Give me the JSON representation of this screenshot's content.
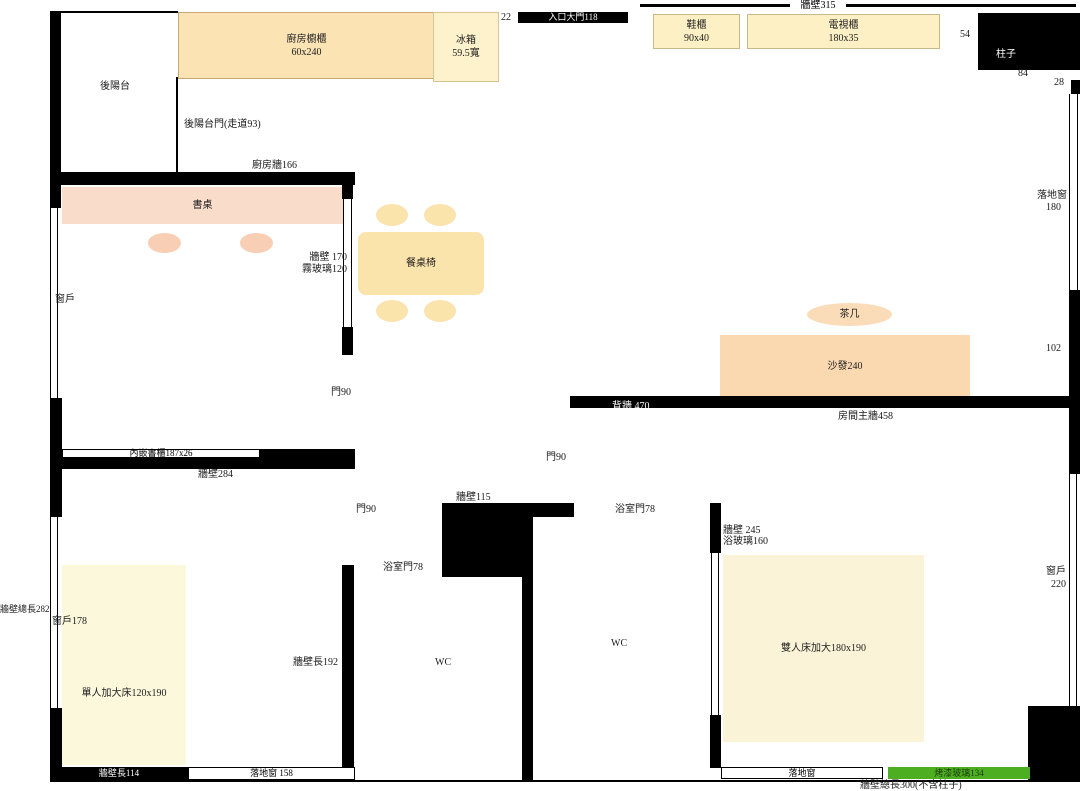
{
  "document": {
    "type": "floor-plan-diagram",
    "units": "cm"
  },
  "colors": {
    "wall": "#000000",
    "kitchen_cabinet_fill": "#FBE3B4",
    "fridge_fill": "#FDF2CB",
    "cabinet_yellow_fill": "#FCF0C4",
    "desk_pink_fill": "#FADCCB",
    "chair_pink_fill": "#F8CFB4",
    "dining_wheat_fill": "#FBE3AC",
    "sofa_peach_fill": "#FBD9B0",
    "coffee_table_fill": "#FBDCB9",
    "single_bed_fill": "#FCF8DC",
    "double_bed_fill": "#FAF3D7",
    "painted_glass_green": "#4CAE20"
  },
  "labels": {
    "balcony": "後陽台",
    "balcony_door": "後陽台門(走道93)",
    "kitchen_cabinet": "廚房櫥櫃",
    "kitchen_cabinet_size": "60x240",
    "fridge": "冰箱",
    "fridge_size": "59.5寬",
    "kitchen_wall": "廚房牆166",
    "gap_22": "22",
    "entry_door": "入口大門118",
    "top_wall": "牆壁315",
    "shoe_cabinet": "鞋櫃",
    "shoe_cabinet_size": "90x40",
    "tv_cabinet": "電視櫃",
    "tv_cabinet_size": "180x35",
    "gap_54": "54",
    "pillar": "柱子",
    "dim_84": "84",
    "dim_28": "28",
    "french_window_right": "落地窗",
    "french_window_right_size": "180",
    "dim_102": "102",
    "desk": "書桌",
    "wall_170": "牆壁 170",
    "frosted_glass": "霧玻璃120",
    "study_window": "窗戶",
    "dining_set": "餐桌椅",
    "study_door": "門90",
    "coffee_table": "茶几",
    "sofa": "沙發240",
    "back_wall": "背牆 470",
    "room_main_wall": "房間主牆458",
    "bookcase": "內嵌書櫃187x26",
    "wall_284": "牆壁284",
    "hall_door": "門90",
    "bedroom1_door": "門90",
    "wall_115": "牆壁115",
    "bath_door_2": "浴室門78",
    "wall_245": "牆壁 245",
    "bath_glass": "浴玻璃160",
    "bath_door_1": "浴室門78",
    "wall_192": "牆壁長192",
    "wc": "WC",
    "left_wall_total": "牆壁總長282",
    "window_178": "窗戶178",
    "single_bed": "單人加大床120x190",
    "double_bed": "雙人床加大180x190",
    "window_220": "窗戶",
    "window_220_size": "220",
    "wall_114": "牆壁長114",
    "floor_window_158": "落地窗 158",
    "floor_window_br": "落地窗",
    "painted_glass": "烤漆玻璃134",
    "bottom_wall_total": "牆壁總長300(不含柱子)"
  }
}
